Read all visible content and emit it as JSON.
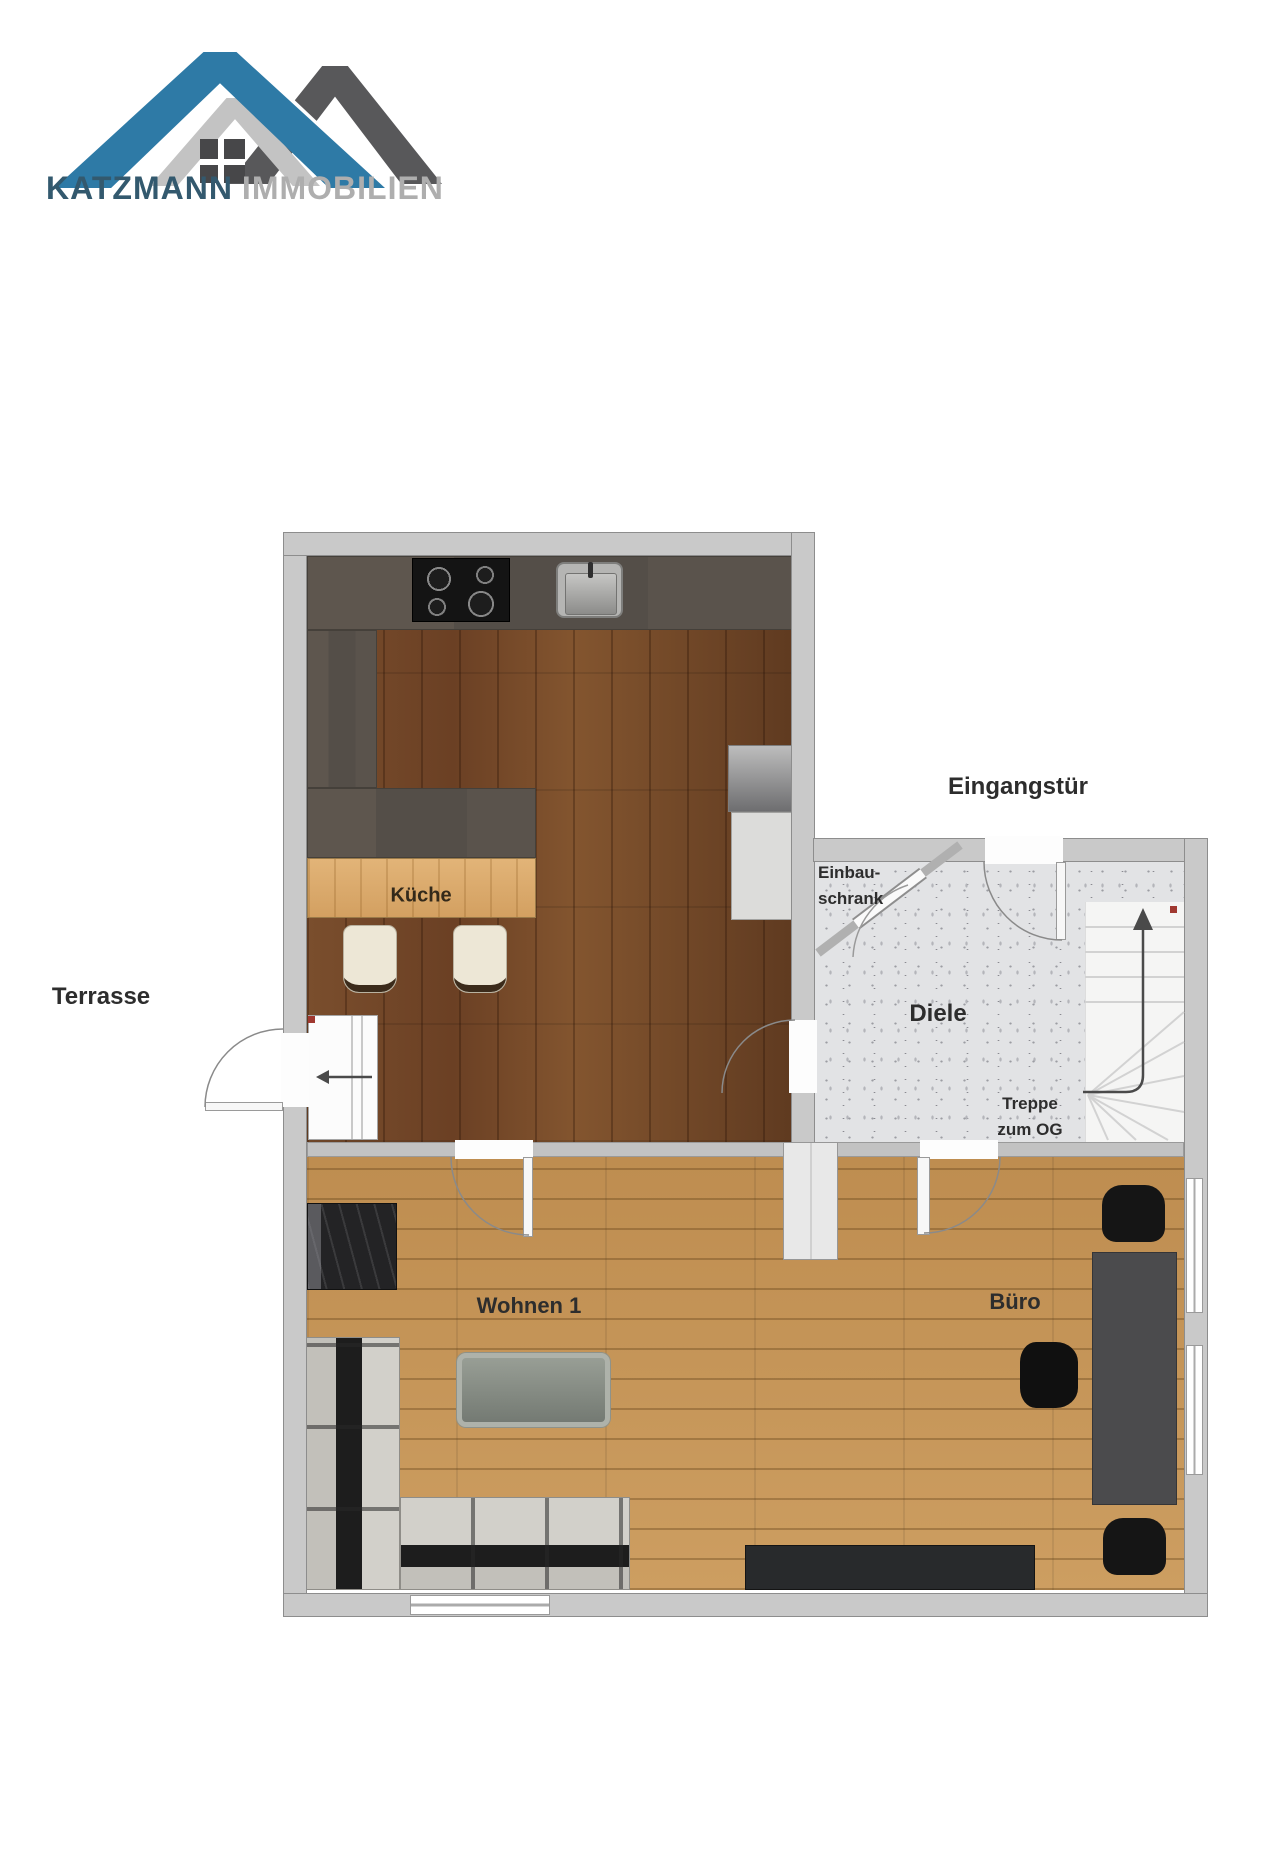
{
  "logo": {
    "brand": "KATZMANN",
    "brand_suffix": "IMMOBILIEN"
  },
  "rooms": {
    "kitchen": "Küche",
    "hall": "Diele",
    "living": "Wohnen 1",
    "office": "Büro"
  },
  "annotations": {
    "entrance": "Eingangstür",
    "terrace": "Terrasse",
    "closet_line1": "Einbau-",
    "closet_line2": "schrank",
    "stairs_line1": "Treppe",
    "stairs_line2": "zum OG"
  },
  "colors": {
    "roof_blue": "#2E7AA6",
    "roof_gray": "#58585A",
    "brand_blue": "#33596E",
    "brand_gray": "#AEAEAE",
    "wall_gray": "#C9C9C9",
    "kitchen_floor_brown": "#714628",
    "living_floor_oak": "#C8995C",
    "hall_floor_speckle": "#E2E3E5",
    "marker_red": "#A03830"
  }
}
